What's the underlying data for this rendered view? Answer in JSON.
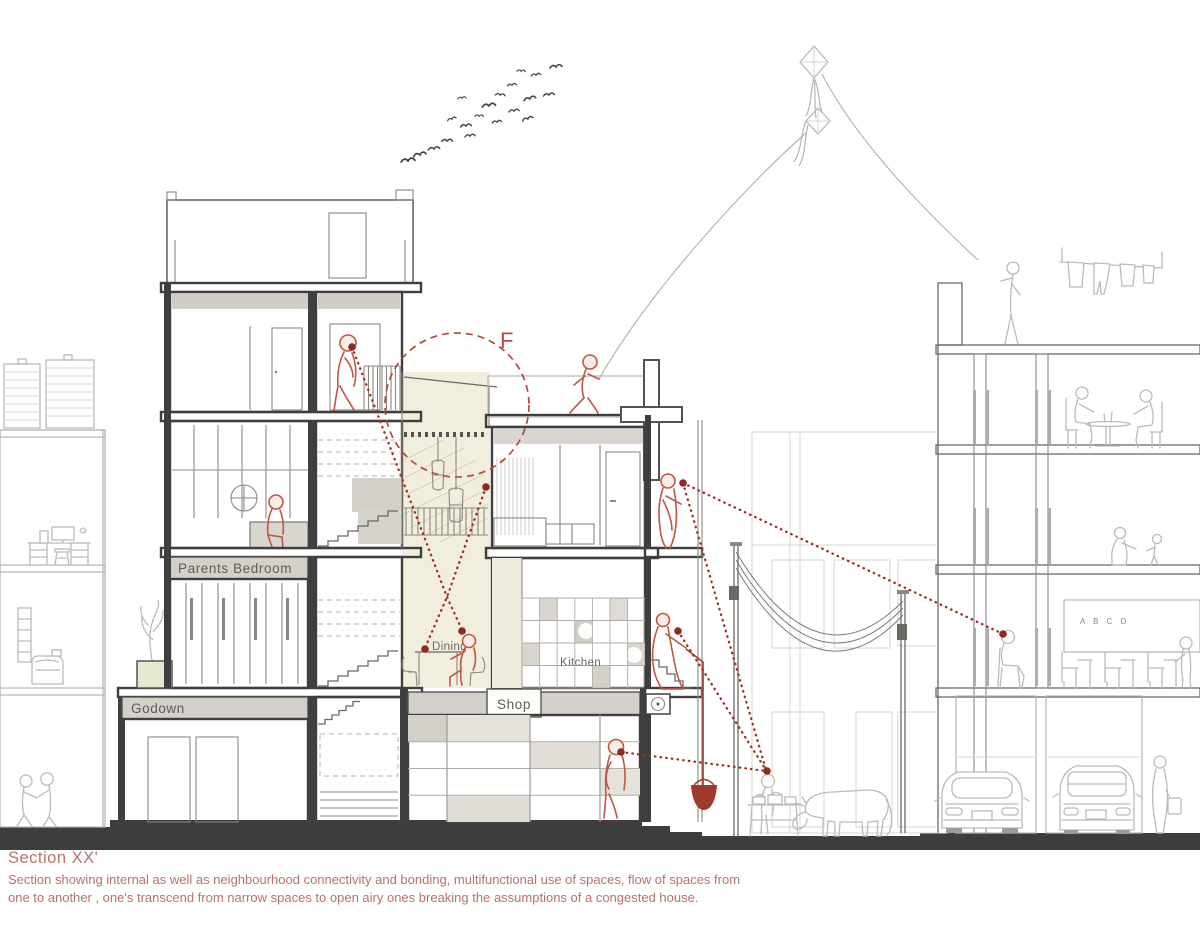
{
  "labels": {
    "parents_bedroom": "Parents Bedroom",
    "godown": "Godown",
    "dining": "Dining",
    "kitchen": "Kitchen",
    "shop": "Shop",
    "focus_marker": "F",
    "classroom_board": "A B C D"
  },
  "caption": {
    "title": "Section XX'",
    "line1": "Section showing internal as well as neighbourhood connectivity and bonding, multifunctional use of spaces, flow of spaces from",
    "line2": "one to another , one's transcend from narrow spaces to open airy ones breaking the assumptions of a congested house."
  },
  "colors": {
    "accent_red": "#9c2f1f",
    "figure_red": "#c05743",
    "caption_text": "#b5736b",
    "ground_dark": "#3d3d3d",
    "cut_wall": "#3f3f3f",
    "band_gray": "#d2d0c9",
    "beige_core": "#f1eedd",
    "line_gray": "#b7b5b0"
  }
}
